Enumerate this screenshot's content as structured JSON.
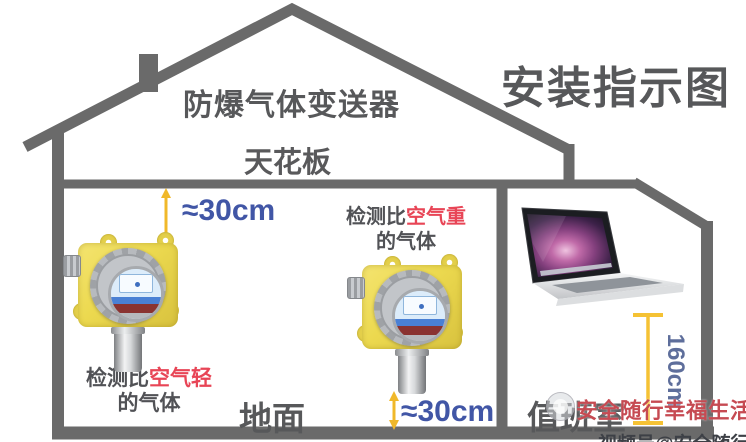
{
  "title": {
    "main": "安装指示图"
  },
  "labels": {
    "device": "防爆气体变送器",
    "ceiling": "天花板",
    "ground": "地面",
    "duty_room": "值班室",
    "distance_top": "≈30cm",
    "distance_bottom": "≈30cm",
    "height_right": "160cm"
  },
  "annotations": {
    "heavy_gas": {
      "prefix": "检测比",
      "highlight": "空气重",
      "suffix": "的气体"
    },
    "light_gas": {
      "prefix": "检测比",
      "highlight": "空气轻",
      "suffix": "的气体"
    }
  },
  "watermark": {
    "brand": "安全随行幸福生活",
    "bottom_cut": "视频号@安全随行幸福生活"
  },
  "colors": {
    "structure": "#6a6a6a",
    "title_text": "#57585a",
    "measure_blue": "#4156a6",
    "arrow_yellow": "#f0b82a",
    "accent_red": "#e84556",
    "height_text": "#5e6e9b",
    "watermark_red": "#c64a52",
    "detector_yellow": "#ecd94f"
  }
}
